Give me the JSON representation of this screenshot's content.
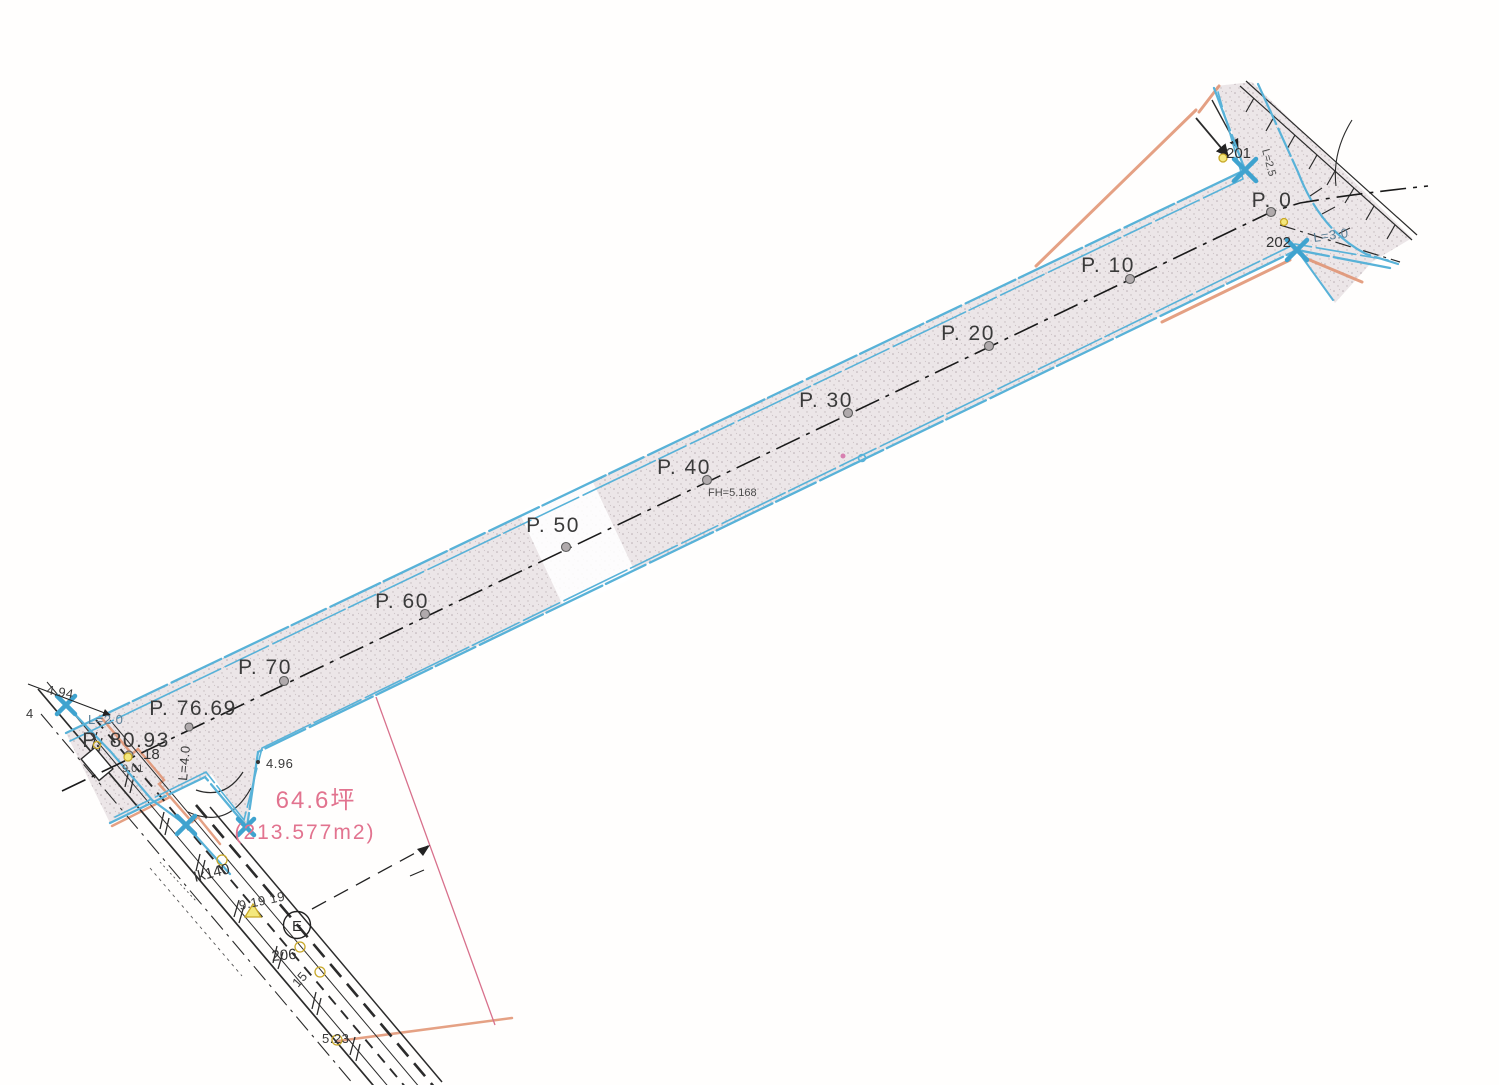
{
  "plan": {
    "stations": [
      {
        "label": "P. 0"
      },
      {
        "label": "P. 10"
      },
      {
        "label": "P. 20"
      },
      {
        "label": "P. 30"
      },
      {
        "label": "P. 40"
      },
      {
        "label": "P. 50"
      },
      {
        "label": "P. 60"
      },
      {
        "label": "P. 70"
      },
      {
        "label": "P. 76.69"
      },
      {
        "label": "P. 80.93"
      }
    ],
    "station_note": "FH=5.168",
    "junction_tr": {
      "pt201": "201",
      "pt202": "202",
      "curve_l30": "L=3.0",
      "curve_l25": "L=2.5"
    },
    "junction_bl": {
      "curve_l20": "L=2.0",
      "curve_l40": "L=4.0",
      "pt18": "18",
      "elev901": "9.01",
      "width4": "4",
      "elev494": "4.94"
    },
    "parcel": {
      "elev496": "4.96",
      "area_tsubo": "64.6坪",
      "area_m2": "(213.577m2)"
    },
    "street": {
      "ik": "Ik140",
      "s919": "9.19 19",
      "bench_e": "E",
      "pt206": "206",
      "pt15": "15",
      "elev523": "5.23"
    },
    "colors": {
      "road_fill": "#ece6e8",
      "waterline_cyan": "#58b2d8",
      "boundary_salmon": "#e0906e",
      "area_pink_text": "#e2738f",
      "parcel_pink_line": "#d8708c",
      "marker_yellow": "#ecd465",
      "ink": "#2b2b2b"
    }
  }
}
